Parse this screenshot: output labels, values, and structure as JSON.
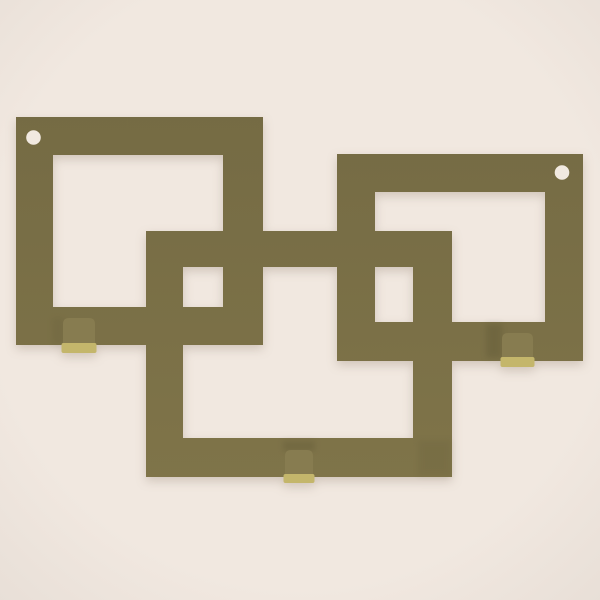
{
  "scene": {
    "description": "3D render of a wall key holder made of three interlocking square frames with two screw holes and three cube hooks",
    "background": {
      "center_color": "#f1e8e0",
      "edge_color": "#e8dfd7"
    },
    "frame_color_top": "#756b44",
    "frame_color_bottom": "#7f7449",
    "hook_body_color": "#877c50",
    "hook_lip_color": "#c4b66b",
    "hole_color": "#f1e9e0",
    "shadow_color": "#554e2f",
    "frames": [
      {
        "name": "left-frame",
        "outer": [
          16,
          117,
          247,
          228
        ],
        "inner": [
          53,
          155,
          170,
          152
        ]
      },
      {
        "name": "right-frame",
        "outer": [
          337,
          154,
          246,
          207
        ],
        "inner": [
          375,
          192,
          170,
          130
        ]
      },
      {
        "name": "center-frame",
        "outer": [
          146,
          231,
          306,
          246
        ],
        "inner": [
          183,
          267,
          230,
          171
        ]
      }
    ],
    "screw_holes": [
      {
        "name": "left-screw-hole",
        "cx": 33.5,
        "cy": 137.5,
        "r": 7.3
      },
      {
        "name": "right-screw-hole",
        "cx": 562.0,
        "cy": 172.5,
        "r": 7.3
      }
    ],
    "hooks": [
      {
        "name": "left-hook",
        "body": [
          63,
          318,
          32,
          27
        ],
        "lip": [
          61.5,
          343,
          35,
          10
        ]
      },
      {
        "name": "right-hook",
        "body": [
          502,
          333,
          31,
          26
        ],
        "lip": [
          500.5,
          357,
          34,
          10
        ]
      },
      {
        "name": "center-hook",
        "body": [
          285,
          450,
          28,
          26
        ],
        "lip": [
          283.5,
          474,
          31,
          9
        ]
      }
    ],
    "soft_shadows": [
      {
        "name": "shadow-left-of-right-hook",
        "rect": [
          486,
          324,
          16,
          34
        ],
        "opacity": 0.28
      },
      {
        "name": "shadow-above-center-hook",
        "rect": [
          283,
          441,
          32,
          10
        ],
        "opacity": 0.26
      },
      {
        "name": "shadow-center-frame-corner",
        "rect": [
          418,
          440,
          33,
          36
        ],
        "opacity": 0.12
      },
      {
        "name": "shadow-left-of-left-hook",
        "rect": [
          52,
          318,
          12,
          27
        ],
        "opacity": 0.12
      }
    ]
  }
}
